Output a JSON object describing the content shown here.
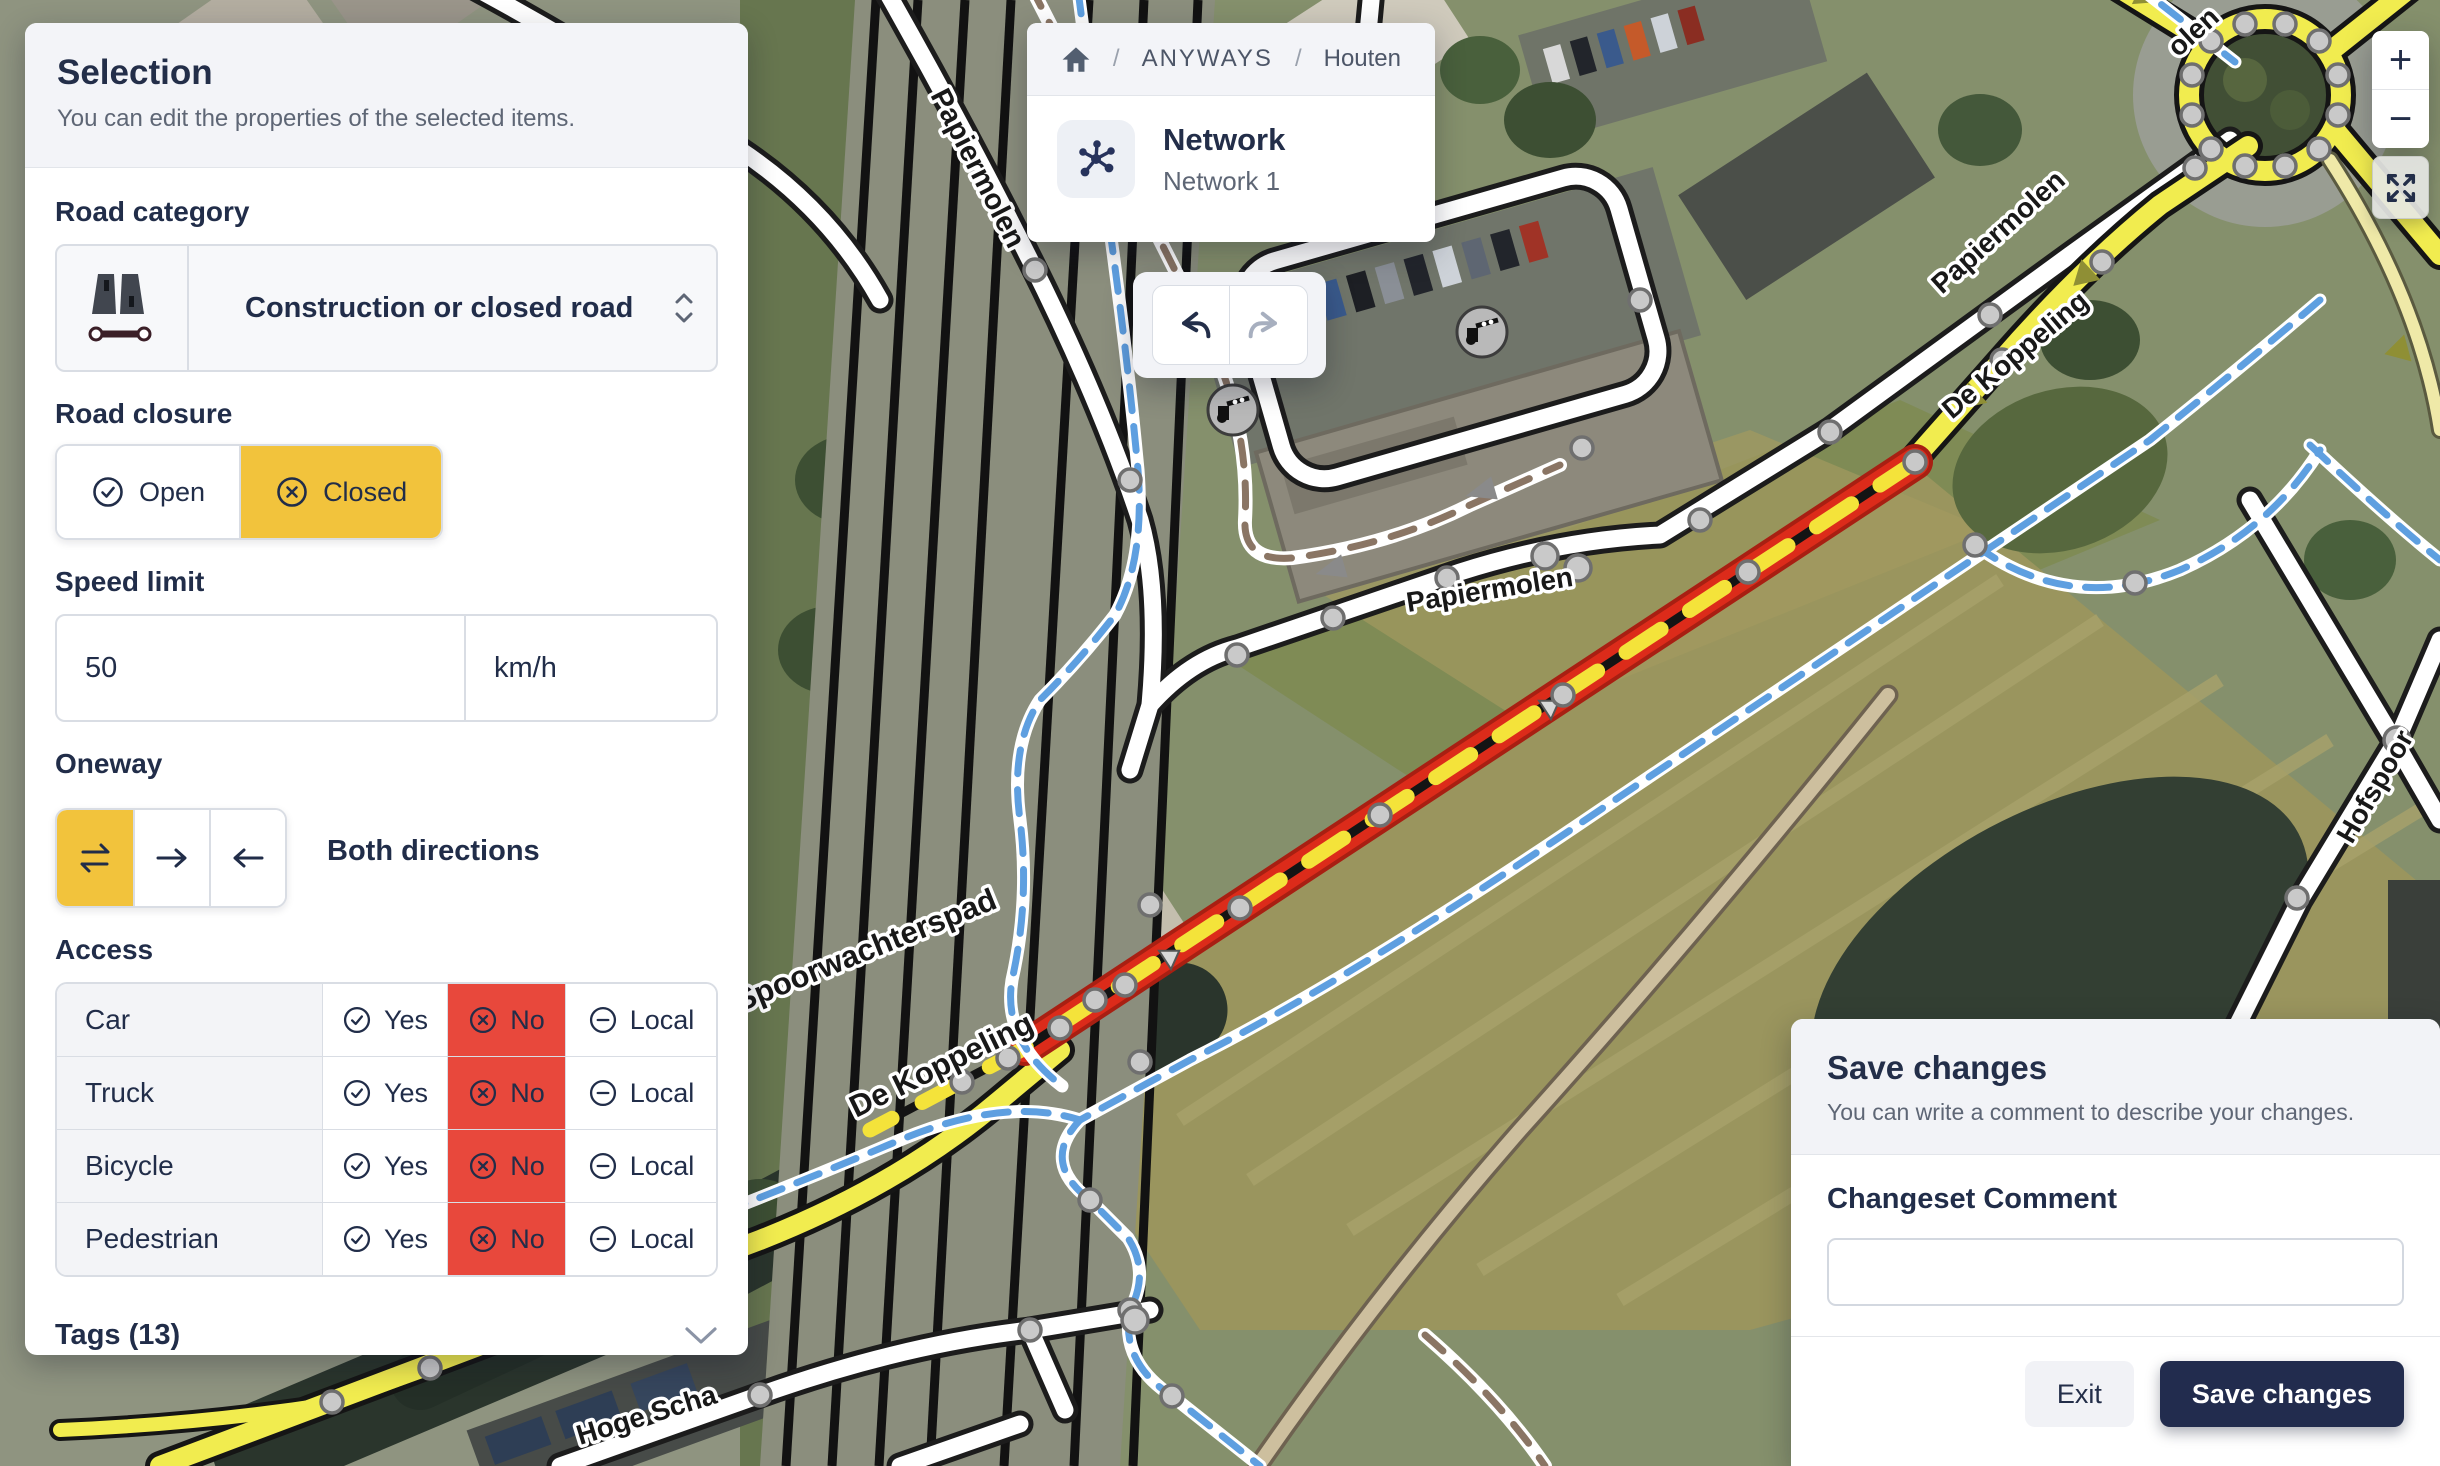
{
  "selection_panel": {
    "title": "Selection",
    "subtitle": "You can edit the properties of the selected items.",
    "road_category": {
      "label": "Road category",
      "value": "Construction or closed road"
    },
    "road_closure": {
      "label": "Road closure",
      "open_label": "Open",
      "closed_label": "Closed",
      "selected": "Closed"
    },
    "speed_limit": {
      "label": "Speed limit",
      "value": "50",
      "unit": "km/h"
    },
    "oneway": {
      "label": "Oneway",
      "selected": "both",
      "value_label": "Both directions"
    },
    "access": {
      "label": "Access",
      "options": {
        "yes": "Yes",
        "no": "No",
        "local": "Local"
      },
      "rows": [
        {
          "name": "Car",
          "value": "No"
        },
        {
          "name": "Truck",
          "value": "No"
        },
        {
          "name": "Bicycle",
          "value": "No"
        },
        {
          "name": "Pedestrian",
          "value": "No"
        }
      ]
    },
    "tags": {
      "label": "Tags (13)"
    }
  },
  "breadcrumb": {
    "separator": "/",
    "items": [
      "ANYWAYS",
      "Houten"
    ]
  },
  "network_card": {
    "title": "Network",
    "subtitle": "Network 1"
  },
  "map_controls": {
    "zoom_in": "+",
    "zoom_out": "−"
  },
  "save_panel": {
    "title": "Save changes",
    "subtitle": "You can write a comment to describe your changes.",
    "comment_label": "Changeset Comment",
    "comment_value": "",
    "exit_label": "Exit",
    "save_label": "Save changes"
  },
  "map": {
    "labels": {
      "papiermolen_top": "Papiermolen",
      "papiermolen_mid": "Papiermolen",
      "papiermolen_ne": "Papiermolen",
      "de_koppeling_ne": "De Koppeling",
      "de_koppeling_sw": "De Koppeling",
      "spoorwachterspad": "Spoorwachterspad",
      "hoge_scha": "Hoge Scha",
      "hofspoor": "Hofspoor",
      "olen_fragment": "olen"
    }
  },
  "colors": {
    "accent_yellow": "#F2C33C",
    "danger_red": "#E8483C",
    "navy": "#232E49",
    "closed_road_red": "#DC2B1A",
    "road_yellow": "#F1EC4F",
    "cycle_blue": "#5E9FE0"
  }
}
